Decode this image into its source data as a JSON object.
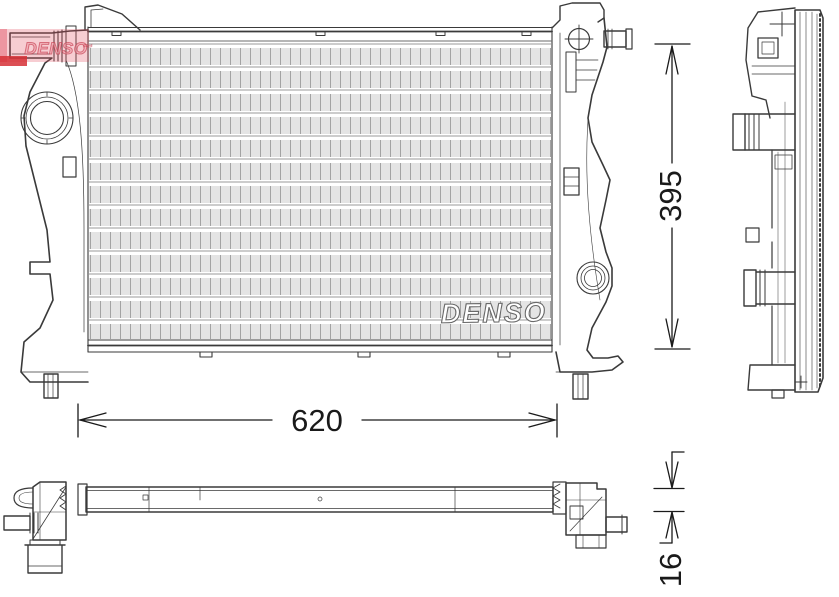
{
  "watermark": {
    "text": "DENSO",
    "swoosh": "~"
  },
  "core_logo": {
    "text": "DENSO"
  },
  "dimensions": {
    "height": "395",
    "width": "620",
    "thickness": "16"
  },
  "colors": {
    "line": "#3a3a3a",
    "fin_light": "#c4c4c4",
    "fin_tube": "#8a8a8a",
    "watermark_red": "#d63036",
    "watermark_pink": "#e14b5c",
    "background": "#ffffff"
  }
}
